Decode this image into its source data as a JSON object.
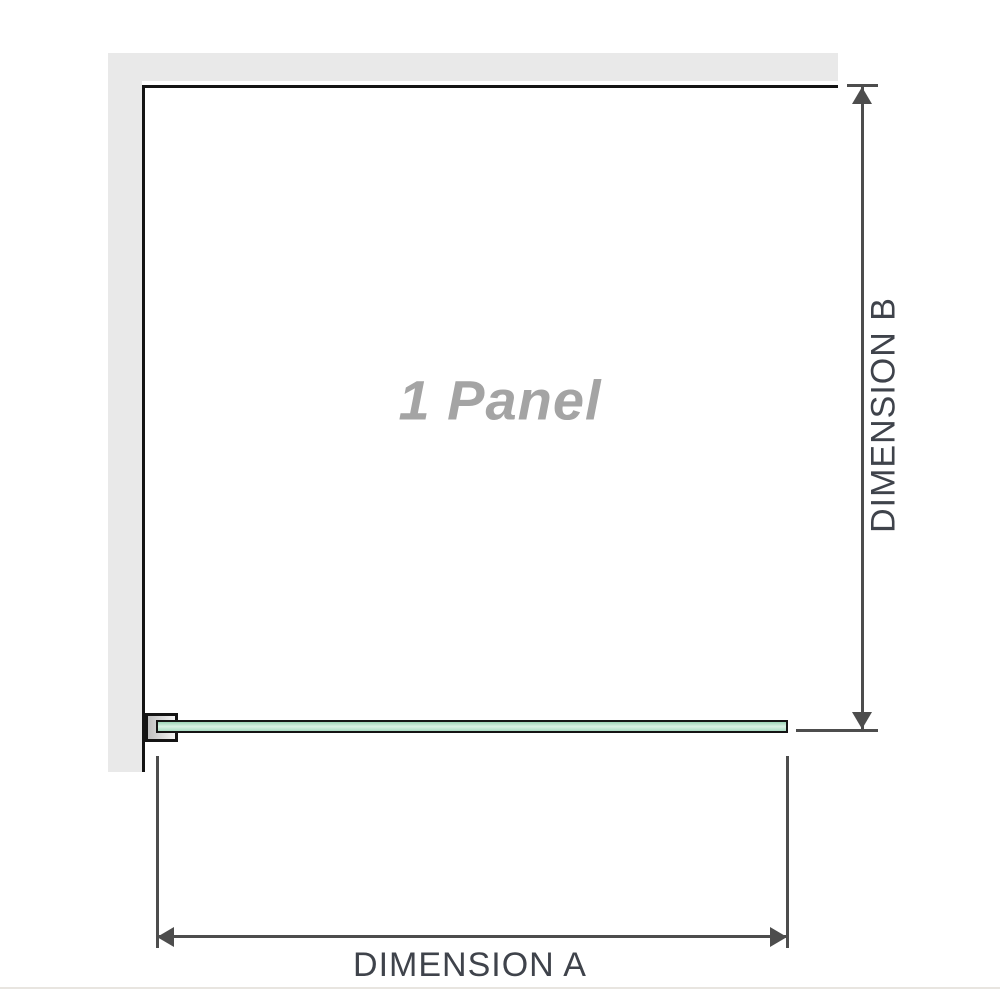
{
  "diagram": {
    "panel_label": "1 Panel",
    "dimension_a_label": "DIMENSION A",
    "dimension_b_label": "DIMENSION B"
  },
  "icons": {
    "arrow_up": "css-triangle-up",
    "arrow_down": "css-triangle-down",
    "arrow_left": "css-triangle-left",
    "arrow_right": "css-triangle-right"
  },
  "colors": {
    "wall": "#e9e9e9",
    "outline": "#141414",
    "dimension": "#4d4d4d",
    "label": "#3f434b",
    "panel_label": "#a4a4a4",
    "glass_top": "#9bd4b6",
    "glass_mid": "#d9f0e3",
    "glass_bottom": "#a8dcc2",
    "bracket_from": "#bfbfbf",
    "bracket_to": "#f4f4f4",
    "bottom_rule": "#e8e5e0"
  }
}
